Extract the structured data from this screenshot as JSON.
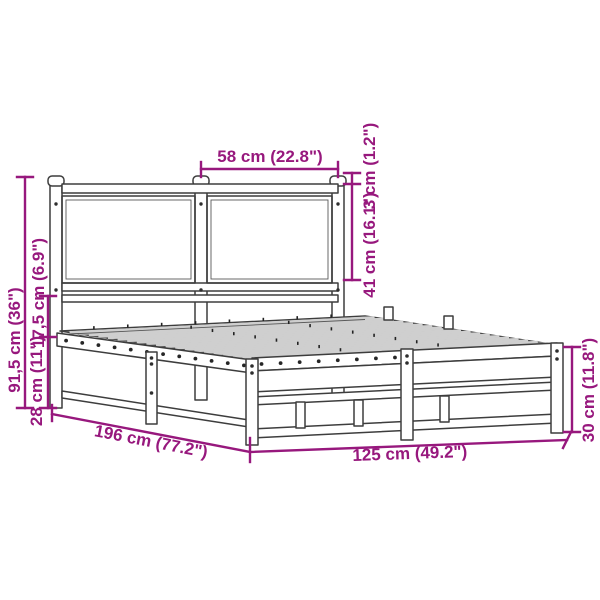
{
  "figure": {
    "title": "Metal bed frame with headboard — dimension diagram",
    "type": "product-dimension-diagram",
    "product": "metal bed frame with slatted base and headboard"
  },
  "colors": {
    "background": "#ffffff",
    "outline": "#3d3d3d",
    "dimension": "#97187d"
  },
  "dimensions": {
    "headboard_panel_width": "58 cm (22.8\")",
    "post_cap_height": "3 cm (1.2\")",
    "headboard_panel_height": "41 cm (16.1\")",
    "total_height": "91,5 cm (36\")",
    "rail_gap_height": "17,5 cm (6.9\")",
    "base_height": "28 cm (11\")",
    "frame_length": "196 cm (77.2\")",
    "frame_width": "125 cm (49.2\")",
    "side_frame_height": "30 cm (11.8\")"
  }
}
